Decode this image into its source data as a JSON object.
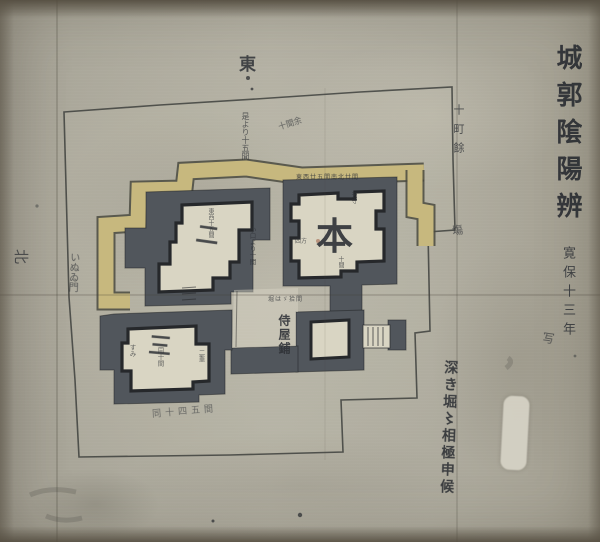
{
  "title_block": {
    "title": "城郭隂陽辨",
    "era_date": "寛保十三年",
    "suffix": "写"
  },
  "compass": {
    "top": "東",
    "left": "北"
  },
  "compounds": {
    "honmaru": "本",
    "ninomaru": "二",
    "sannomaru": "三",
    "samurai_quarter": "侍屋鋪"
  },
  "annotations": {
    "right_distance": "十町餘",
    "right_distance_2": "塲",
    "left_gate_note": "いぬゐ門",
    "top_note_a": "是より十五間",
    "top_note_b": "十間余",
    "honmaru_top_row": "東西廿五間南北廿間",
    "honmaru_keep": "天守",
    "honmaru_size": "四方",
    "honmaru_inner": "十間",
    "honmaru_bottom_row": "堀はゞ拾間",
    "between_moats_note": "小口より十間",
    "ninomaru_note": "東西十五間",
    "sannomaru_note_a": "すみ",
    "sannomaru_note_b": "同十間",
    "sannomaru_note_c": "二重",
    "bottom_cursive_note": "同十四五間",
    "right_cursive_note": "深き堀〻相極申候"
  },
  "palette": {
    "paper": "#aba79b",
    "moat": "#51565c",
    "rampart": "#c7b87e",
    "compound": "#d9d5c3",
    "ink": "#2f3237"
  }
}
